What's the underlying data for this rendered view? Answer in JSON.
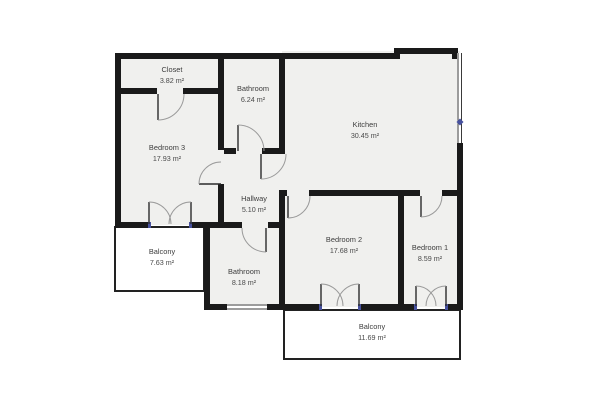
{
  "title": "Apartment floor plan",
  "colors": {
    "wall": "#1a1a1a",
    "floor": "#f0f0ee",
    "accent": "#47519e",
    "door_arc": "#9a9a9a",
    "label": "#3d3d3d",
    "background": "#ffffff"
  },
  "rooms": [
    {
      "name": "Closet",
      "area": "3.82 m²"
    },
    {
      "name": "Bathroom",
      "area": "6.24 m²"
    },
    {
      "name": "Kitchen",
      "area": "30.45 m²"
    },
    {
      "name": "Bedroom 3",
      "area": "17.93 m²"
    },
    {
      "name": "Hallway",
      "area": "5.10 m²"
    },
    {
      "name": "Balcony",
      "area": "7.63 m²"
    },
    {
      "name": "Bathroom",
      "area": "8.18 m²"
    },
    {
      "name": "Bedroom 2",
      "area": "17.68 m²"
    },
    {
      "name": "Bedroom 1",
      "area": "8.59 m²"
    },
    {
      "name": "Balcony",
      "area": "11.69 m²"
    }
  ]
}
